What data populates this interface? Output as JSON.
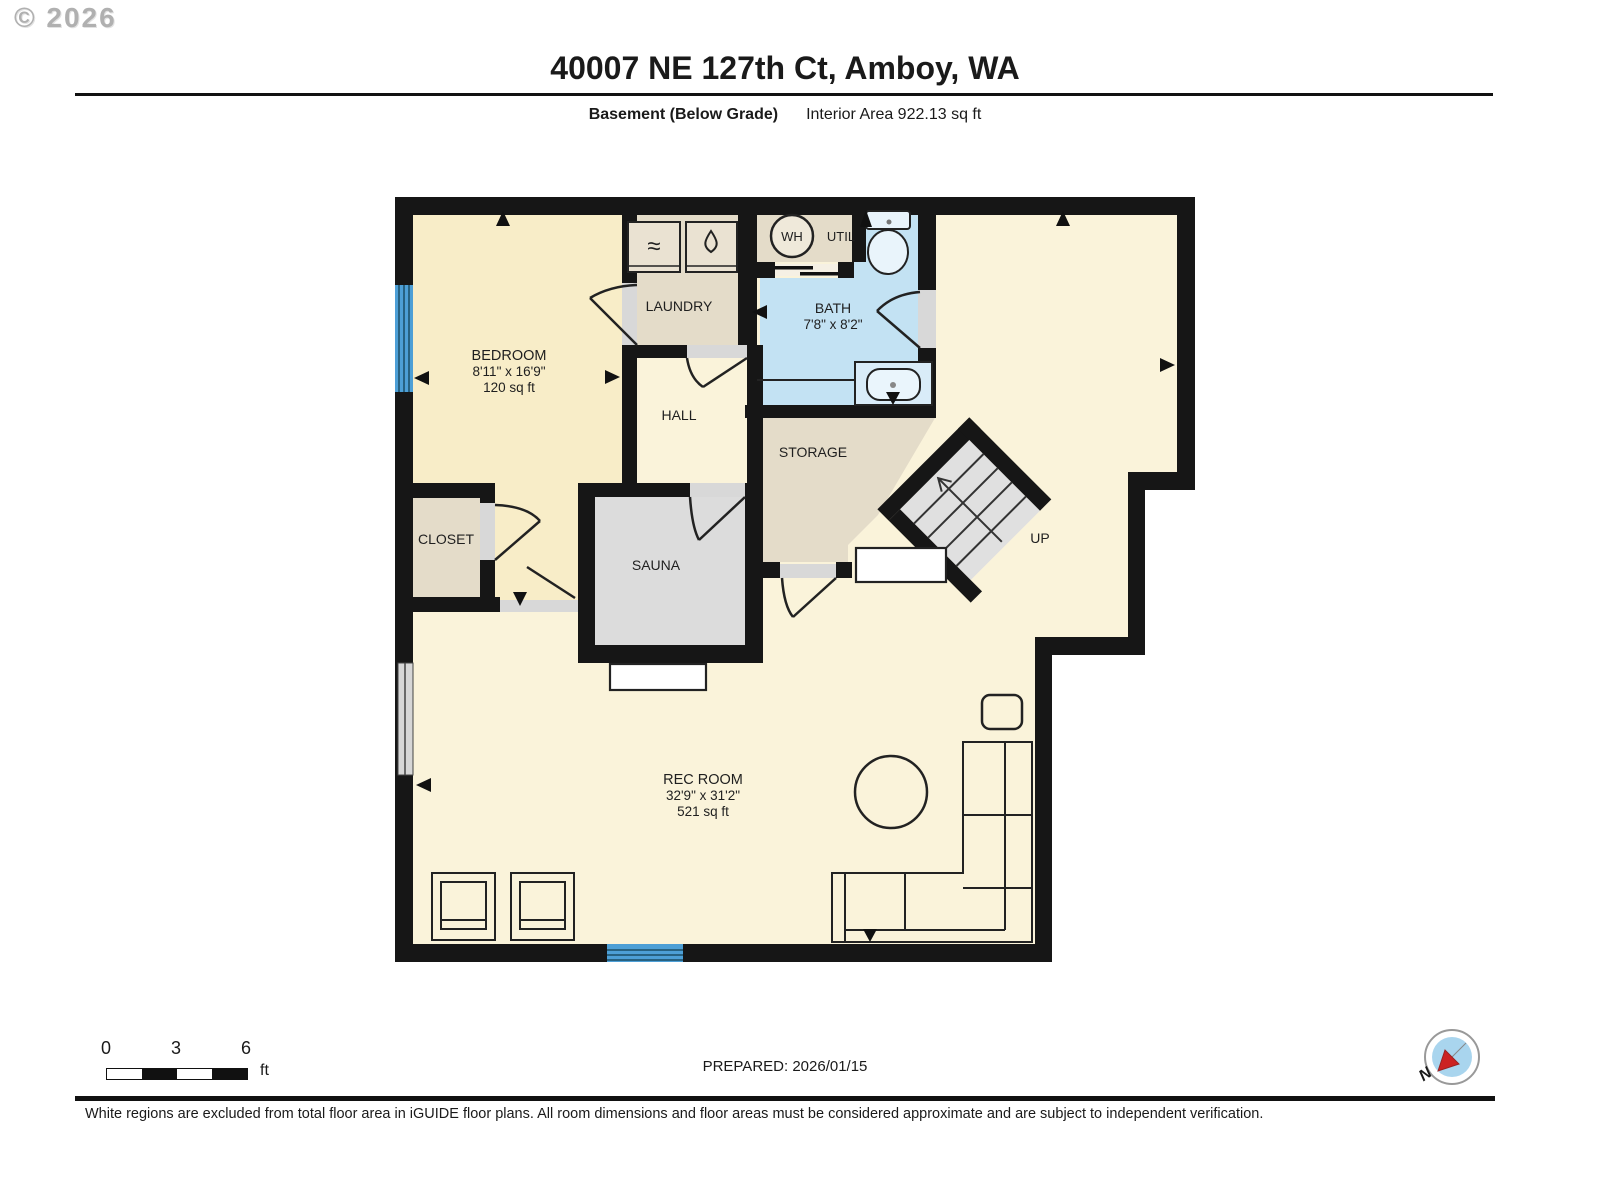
{
  "header": {
    "copyright": "© 2026",
    "title": "40007 NE 127th Ct, Amboy, WA",
    "floor": "Basement (Below Grade)",
    "area": "Interior Area 922.13 sq ft"
  },
  "rooms": {
    "bedroom": {
      "name": "BEDROOM",
      "dims": "8'11\" x 16'9\"",
      "area": "120 sq ft"
    },
    "laundry": {
      "name": "LAUNDRY"
    },
    "bath": {
      "name": "BATH",
      "dims": "7'8\" x 8'2\""
    },
    "hall": {
      "name": "HALL"
    },
    "storage": {
      "name": "STORAGE"
    },
    "closet": {
      "name": "CLOSET"
    },
    "sauna": {
      "name": "SAUNA"
    },
    "rec_room": {
      "name": "REC ROOM",
      "dims": "32'9\" x 31'2\"",
      "area": "521 sq ft"
    },
    "water_heater": "WH",
    "utility": "UTIL",
    "stairs_up": "UP"
  },
  "scale_bar": {
    "tick0": "0",
    "tick3": "3",
    "tick6": "6",
    "unit": "ft"
  },
  "footer": {
    "prepared": "PREPARED: 2026/01/15",
    "disclaimer": "White regions are excluded from total floor area in iGUIDE floor plans. All room dimensions and floor areas must be considered approximate and are subject to independent verification.",
    "compass_north": "N"
  },
  "colors": {
    "wall": "#161616",
    "floor_cream": "#faf3da",
    "floor_yellow": "#f8edc8",
    "floor_tan": "#e4dcc9",
    "floor_blue": "#c3e2f3",
    "floor_gray": "#dcdcdc",
    "window_blue": "#4d9fd6",
    "compass_blue": "#a9d5ee",
    "compass_red": "#cc2222"
  }
}
